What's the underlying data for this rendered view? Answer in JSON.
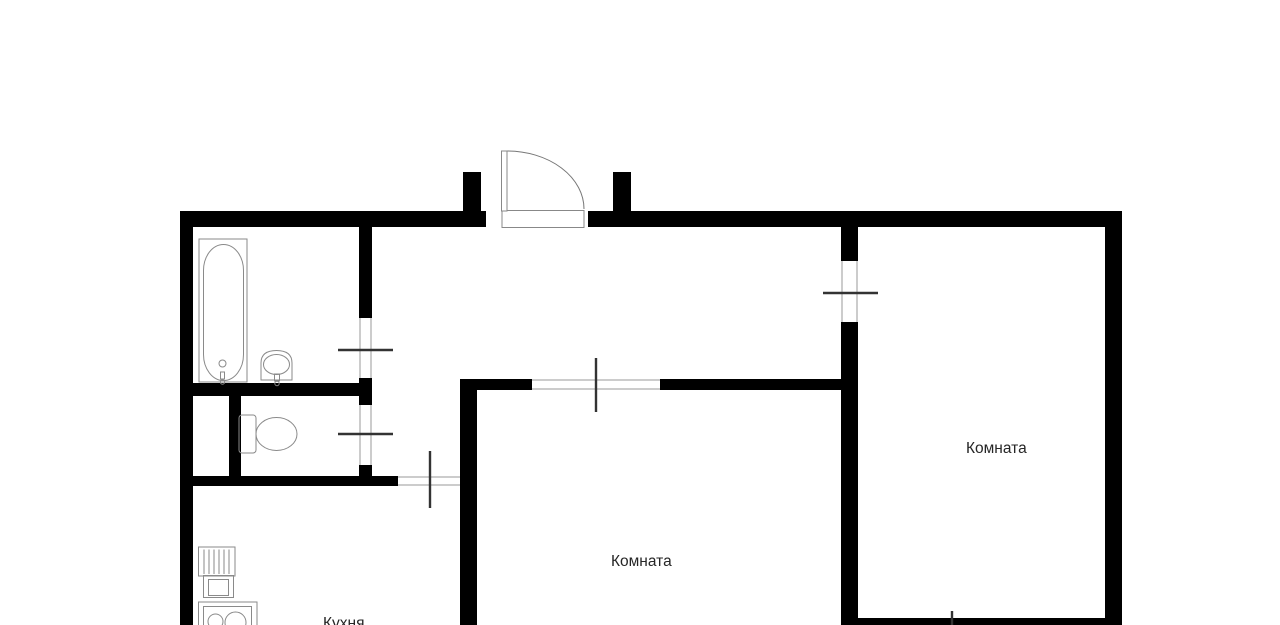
{
  "floorplan": {
    "labels": {
      "kitchen": "Кухня",
      "room_center": "Комната",
      "room_right": "Комната"
    },
    "colors": {
      "background": "#ffffff",
      "wall": "#000000",
      "opening_jamb": "#999999",
      "tick": "#333333",
      "fixture_outline": "#8a8a8a",
      "door_swing": "#777777",
      "label_text": "#262626"
    },
    "fixtures": [
      "bathtub-icon",
      "washbasin-icon",
      "toilet-icon",
      "kitchen-counter-icon",
      "kitchen-sink-icon",
      "stove-icon",
      "entrance-door-icon"
    ]
  }
}
